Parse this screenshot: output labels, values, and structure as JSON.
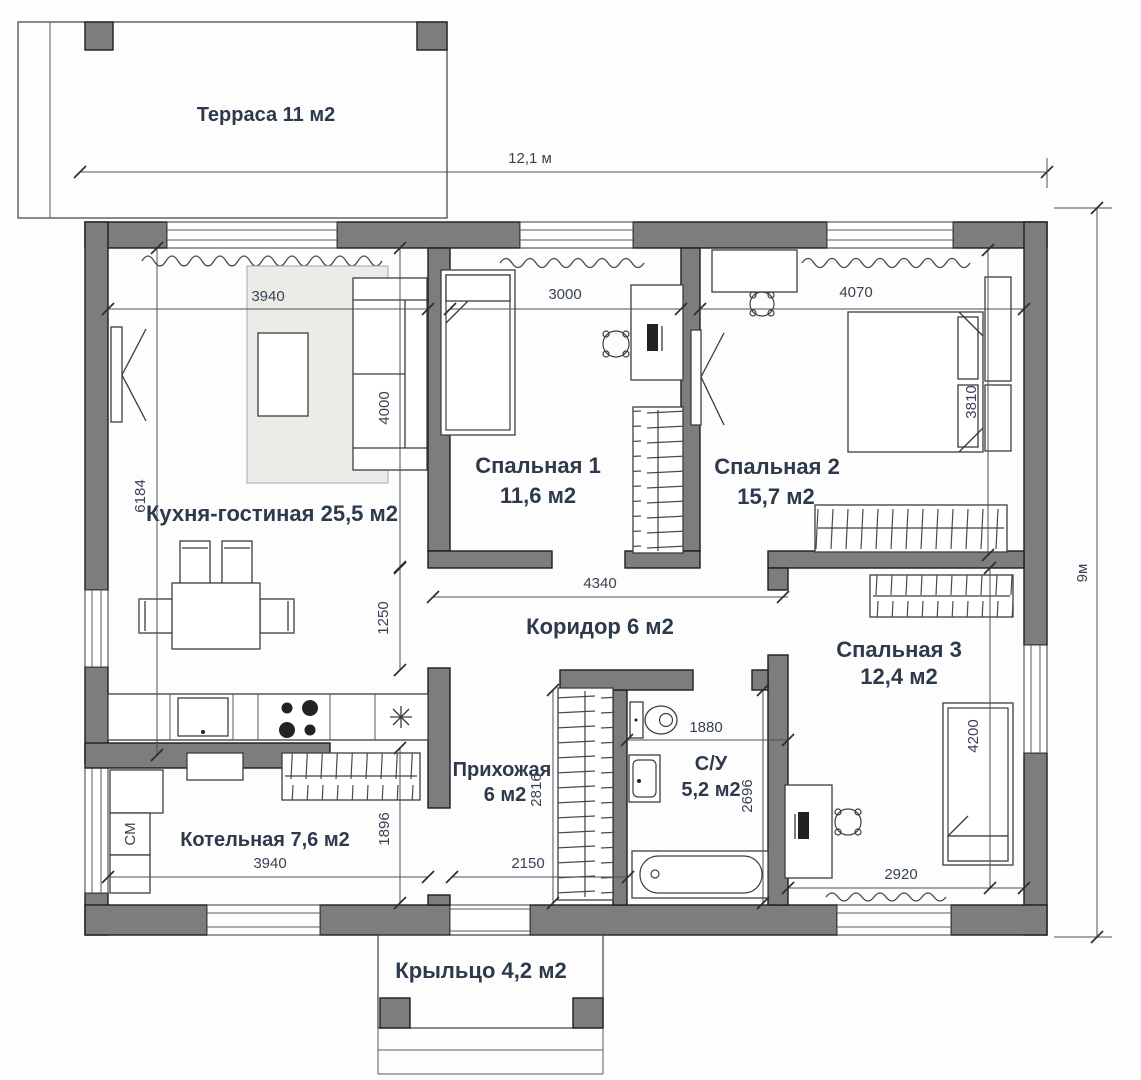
{
  "plan": {
    "rooms": {
      "terrace": {
        "label": "Терраса 11 м2"
      },
      "kitchen_living": {
        "label": "Кухня-гостиная 25,5 м2"
      },
      "bedroom1": {
        "name": "Спальная 1",
        "area": "11,6 м2"
      },
      "bedroom2": {
        "name": "Спальная 2",
        "area": "15,7 м2"
      },
      "corridor": {
        "label": "Коридор 6 м2"
      },
      "hallway": {
        "name": "Прихожая",
        "area": "6 м2"
      },
      "bathroom": {
        "name": "С/У",
        "area": "5,2 м2"
      },
      "bedroom3": {
        "name": "Спальная 3",
        "area": "12,4 м2"
      },
      "boiler": {
        "label": "Котельная 7,6 м2"
      },
      "porch": {
        "label": "Крыльцо 4,2 м2"
      }
    },
    "dims": {
      "total_width": "12,1 м",
      "total_height": "9м",
      "kitchen_width": "3940",
      "bedroom1_width": "3000",
      "bedroom2_width": "4070",
      "sofa_zone_depth": "4000",
      "kitchen_depth": "6184",
      "kitchen_opening": "1250",
      "corridor_width": "4340",
      "bedrooms_depth": "3810",
      "hallway_depth": "2816",
      "hallway_width": "2150",
      "bathroom_width": "1880",
      "bathroom_depth": "2696",
      "boiler_depth": "1896",
      "boiler_width": "3940",
      "bedroom3_width": "2920",
      "bedroom3_depth": "4200"
    },
    "appliances": {
      "washing_machine": "СМ"
    },
    "colors": {
      "wall_fill": "#7d7d7d",
      "wall_stroke": "#1d1d1d",
      "label_text": "#2d3a4c",
      "dim_text": "#394252",
      "rug_fill": "#ebece8",
      "background": "#fdfdfd"
    }
  }
}
